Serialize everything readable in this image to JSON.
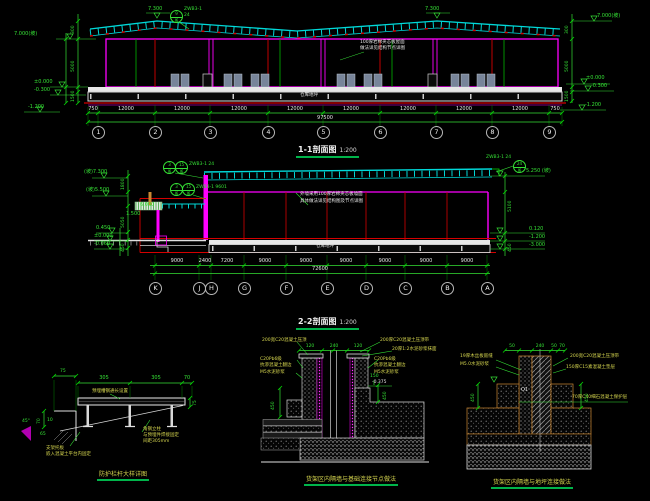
{
  "drawing": {
    "background": "#000000",
    "accent_green": "#00b44a",
    "line_cyan": "#00d9d9",
    "line_magenta": "#ff00ff",
    "line_red": "#d40000",
    "line_green": "#35e035",
    "text_yellow": "#d6d64f"
  },
  "top": {
    "title": "1-1剖面图",
    "scale": "1:200",
    "peak_elevation_1": "7.300",
    "peak_elevation_2": "7.300",
    "left_elevation_top": "7.000(坡)",
    "left_elevations": [
      "±0.000",
      "-0.300",
      "-1.200"
    ],
    "right_elevation_top": "7.000(坡)",
    "right_elevations": [
      "±0.000",
      "-0.300",
      "-1.200"
    ],
    "left_chain_dims": [
      "300",
      "5000",
      "1500"
    ],
    "right_chain_dims": [
      "300",
      "5000",
      "1500"
    ],
    "callout": {
      "top": "9",
      "bottom": "J6",
      "label": "ZWB3-1",
      "sub": "24"
    },
    "roof_note_line1": "100厚岩棉夹芯板屋面",
    "roof_note_line2": "做法详见结构节点详图",
    "slab_label": "仓库地坪",
    "grid_bubbles": [
      "1",
      "2",
      "3",
      "4",
      "5",
      "6",
      "7",
      "8",
      "9"
    ],
    "dims": [
      "750",
      "12000",
      "12000",
      "12000",
      "12000",
      "12000",
      "12000",
      "12000",
      "12000",
      "750"
    ],
    "total_dim": "97500"
  },
  "middle": {
    "title": "2-2剖面图",
    "scale": "1:200",
    "left_elevation_1": "(坡)7.300",
    "left_elevation_2": "(坡)5.500",
    "left_elevations": [
      "0.450",
      "±0.000",
      "-0.060"
    ],
    "left_chain_dims": [
      "1800",
      "5050",
      "450"
    ],
    "right_elevation_top": "5.250 (坡)",
    "right_elevations": [
      "0.120",
      "-1.200",
      "-3.000"
    ],
    "right_chain_dims": [
      "5100",
      "450"
    ],
    "canopy_dim_1": "6.000",
    "canopy_dim_2": "1.500",
    "callouts": {
      "c1_top": "3",
      "c1_bot": "J6",
      "c2_top": "15",
      "c2_bot": "J6",
      "c12_label": "ZWB3-1 24",
      "c3_top": "3",
      "c3_bot": "J6",
      "c4_top": "15",
      "c4_bot": "J6",
      "c34_label": "ZWB3-1 9601",
      "c5_top": "24",
      "c5_bot": "J6",
      "c5_label": "ZWB3-1 24"
    },
    "note_line1": "外墙采用100厚岩棉夹芯板墙面",
    "note_line2": "具体做法详见结构图及节点详图",
    "slab_label": "仓库地坪",
    "grid_bubbles": [
      "K",
      "J",
      "H",
      "G",
      "F",
      "E",
      "D",
      "C",
      "B",
      "A"
    ],
    "dims": [
      "9000",
      "2400",
      "7200",
      "9000",
      "9000",
      "9000",
      "9000",
      "9000",
      "9000"
    ],
    "total_dim": "72600"
  },
  "detail1": {
    "title": "防护栏杆大样详图",
    "dims_top": [
      "305",
      "305",
      "70"
    ],
    "dim_right": "75",
    "bracket_dims": {
      "a": "75",
      "b": "70",
      "c": "10",
      "d": "65",
      "e": "45°"
    },
    "note_beam": "预埋槽钢通长设置",
    "note_right_1": "角钢立柱",
    "note_right_2": "与预埋件焊接固定",
    "note_right_3": "间距305mm",
    "note_left_1": "支架托板",
    "note_left_2": "嵌入混凝土平台内固定"
  },
  "detail2": {
    "title": "货架区内隔墙与基础连接节点做法",
    "dims_top": [
      "120",
      "240",
      "120"
    ],
    "note_top_left": "200宽C20混凝土压顶",
    "notes_left": [
      "C20Pb6级",
      "抗渗混凝土翻边",
      "M5水泥砂浆"
    ],
    "note_top_right_1": "200厚C20混凝土压顶带",
    "note_top_right_2": "20厚1:2水泥砂浆抹面",
    "notes_right": [
      "C20Pb6级",
      "抗渗混凝土翻边",
      "M5水泥砂浆"
    ],
    "dim_left": "450",
    "dim_right": "450",
    "dim_right_2": "150",
    "elevation_right": "-0.375"
  },
  "detail3": {
    "title": "货架区内隔墙与地坪连接做法",
    "dims_top": [
      "50",
      "240",
      "50",
      "70"
    ],
    "note_top_left_1": "19厚木丝板嵌缝",
    "note_top_left_2": "M5.0水泥砂浆",
    "note_top_right_1": "200宽C20混凝土压顶带",
    "note_top_right_2": "150厚C15素混凝土垫层",
    "note_right_3": "70厚C40细石混凝土保护层",
    "dim_left": "450",
    "dim_right": "450",
    "wall_tag": "Q1"
  }
}
